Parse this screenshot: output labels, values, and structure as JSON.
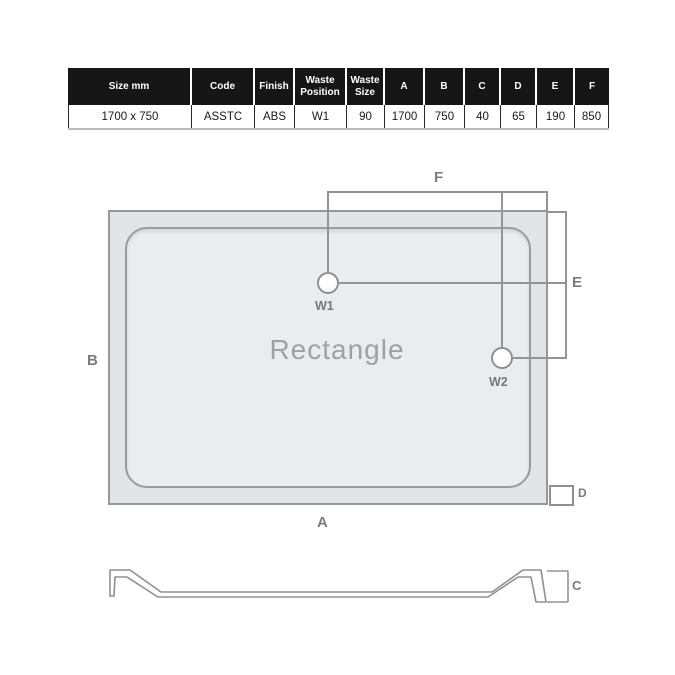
{
  "spec_table": {
    "headers": [
      "Size mm",
      "Code",
      "Finish",
      "Waste Position",
      "Waste Size",
      "A",
      "B",
      "C",
      "D",
      "E",
      "F"
    ],
    "row": [
      "1700 x 750",
      "ASSTC",
      "ABS",
      "W1",
      "90",
      "1700",
      "750",
      "40",
      "65",
      "190",
      "850"
    ]
  },
  "plan": {
    "shape_label": "Rectangle",
    "dim_labels": {
      "a": "A",
      "b": "B",
      "d": "D",
      "e": "E",
      "f": "F"
    },
    "waste1_label": "W1",
    "waste2_label": "W2"
  },
  "profile": {
    "dim_label": "C"
  },
  "colors": {
    "table_header_bg": "#161616",
    "table_header_text": "#ffffff",
    "dimension_line_gray": "#939499",
    "dim_label_gray": "#7b7c82",
    "tray_rim_fill": "#e3e4e8",
    "tray_inner_fill": "#ebecf0",
    "shape_label_gray": "#9fa0a6"
  }
}
